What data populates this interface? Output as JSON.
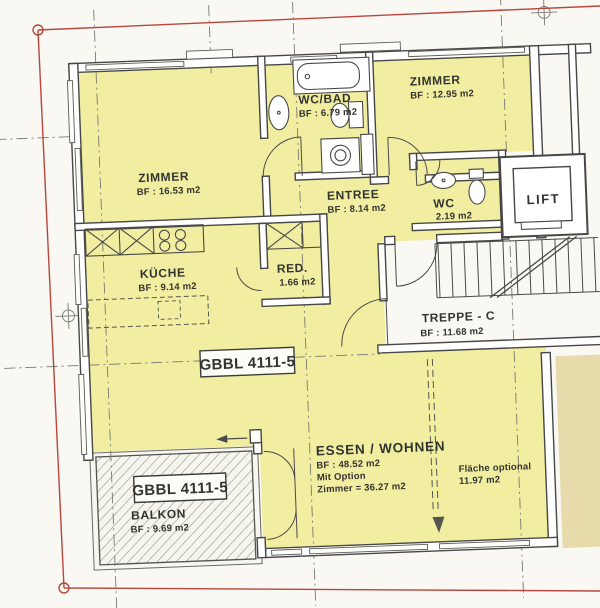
{
  "rooms": {
    "zimmer_right": {
      "name": "ZIMMER",
      "area": "BF : 12.95 m2"
    },
    "wc_bad": {
      "name": "WC/BAD",
      "area": "BF : 6.79 m2"
    },
    "zimmer_left": {
      "name": "ZIMMER",
      "area": "BF : 16.53 m2"
    },
    "entree": {
      "name": "ENTREE",
      "area": "BF : 8.14 m2"
    },
    "wc": {
      "name": "WC",
      "area": "2.19 m2"
    },
    "lift": {
      "name": "LIFT"
    },
    "kueche": {
      "name": "KÜCHE",
      "area": "BF : 9.14 m2"
    },
    "red": {
      "name": "RED.",
      "area": "1.66 m2"
    },
    "treppe": {
      "name": "TREPPE - C",
      "area": "BF : 11.68 m2"
    },
    "essen_wohnen": {
      "name": "ESSEN / WOHNEN",
      "area": "BF : 48.52 m2",
      "option_line1": "Mit Option",
      "option_line2": "Zimmer = 36.27 m2"
    },
    "flaeche_optional": {
      "name": "Fläche optional",
      "area": "11.97 m2"
    },
    "balkon": {
      "name": "BALKON",
      "area": "BF : 9.69 m2"
    }
  },
  "labels": {
    "unit_box_center": "GBBL 4111-5",
    "unit_box_balcony": "GBBL 4111-5"
  },
  "style": {
    "room_fill": "#f1eea1",
    "neighbor_fill": "#e7dbab",
    "frame_color": "#b8463e",
    "wall_color": "#474747",
    "paper": "#f9f8f3"
  }
}
